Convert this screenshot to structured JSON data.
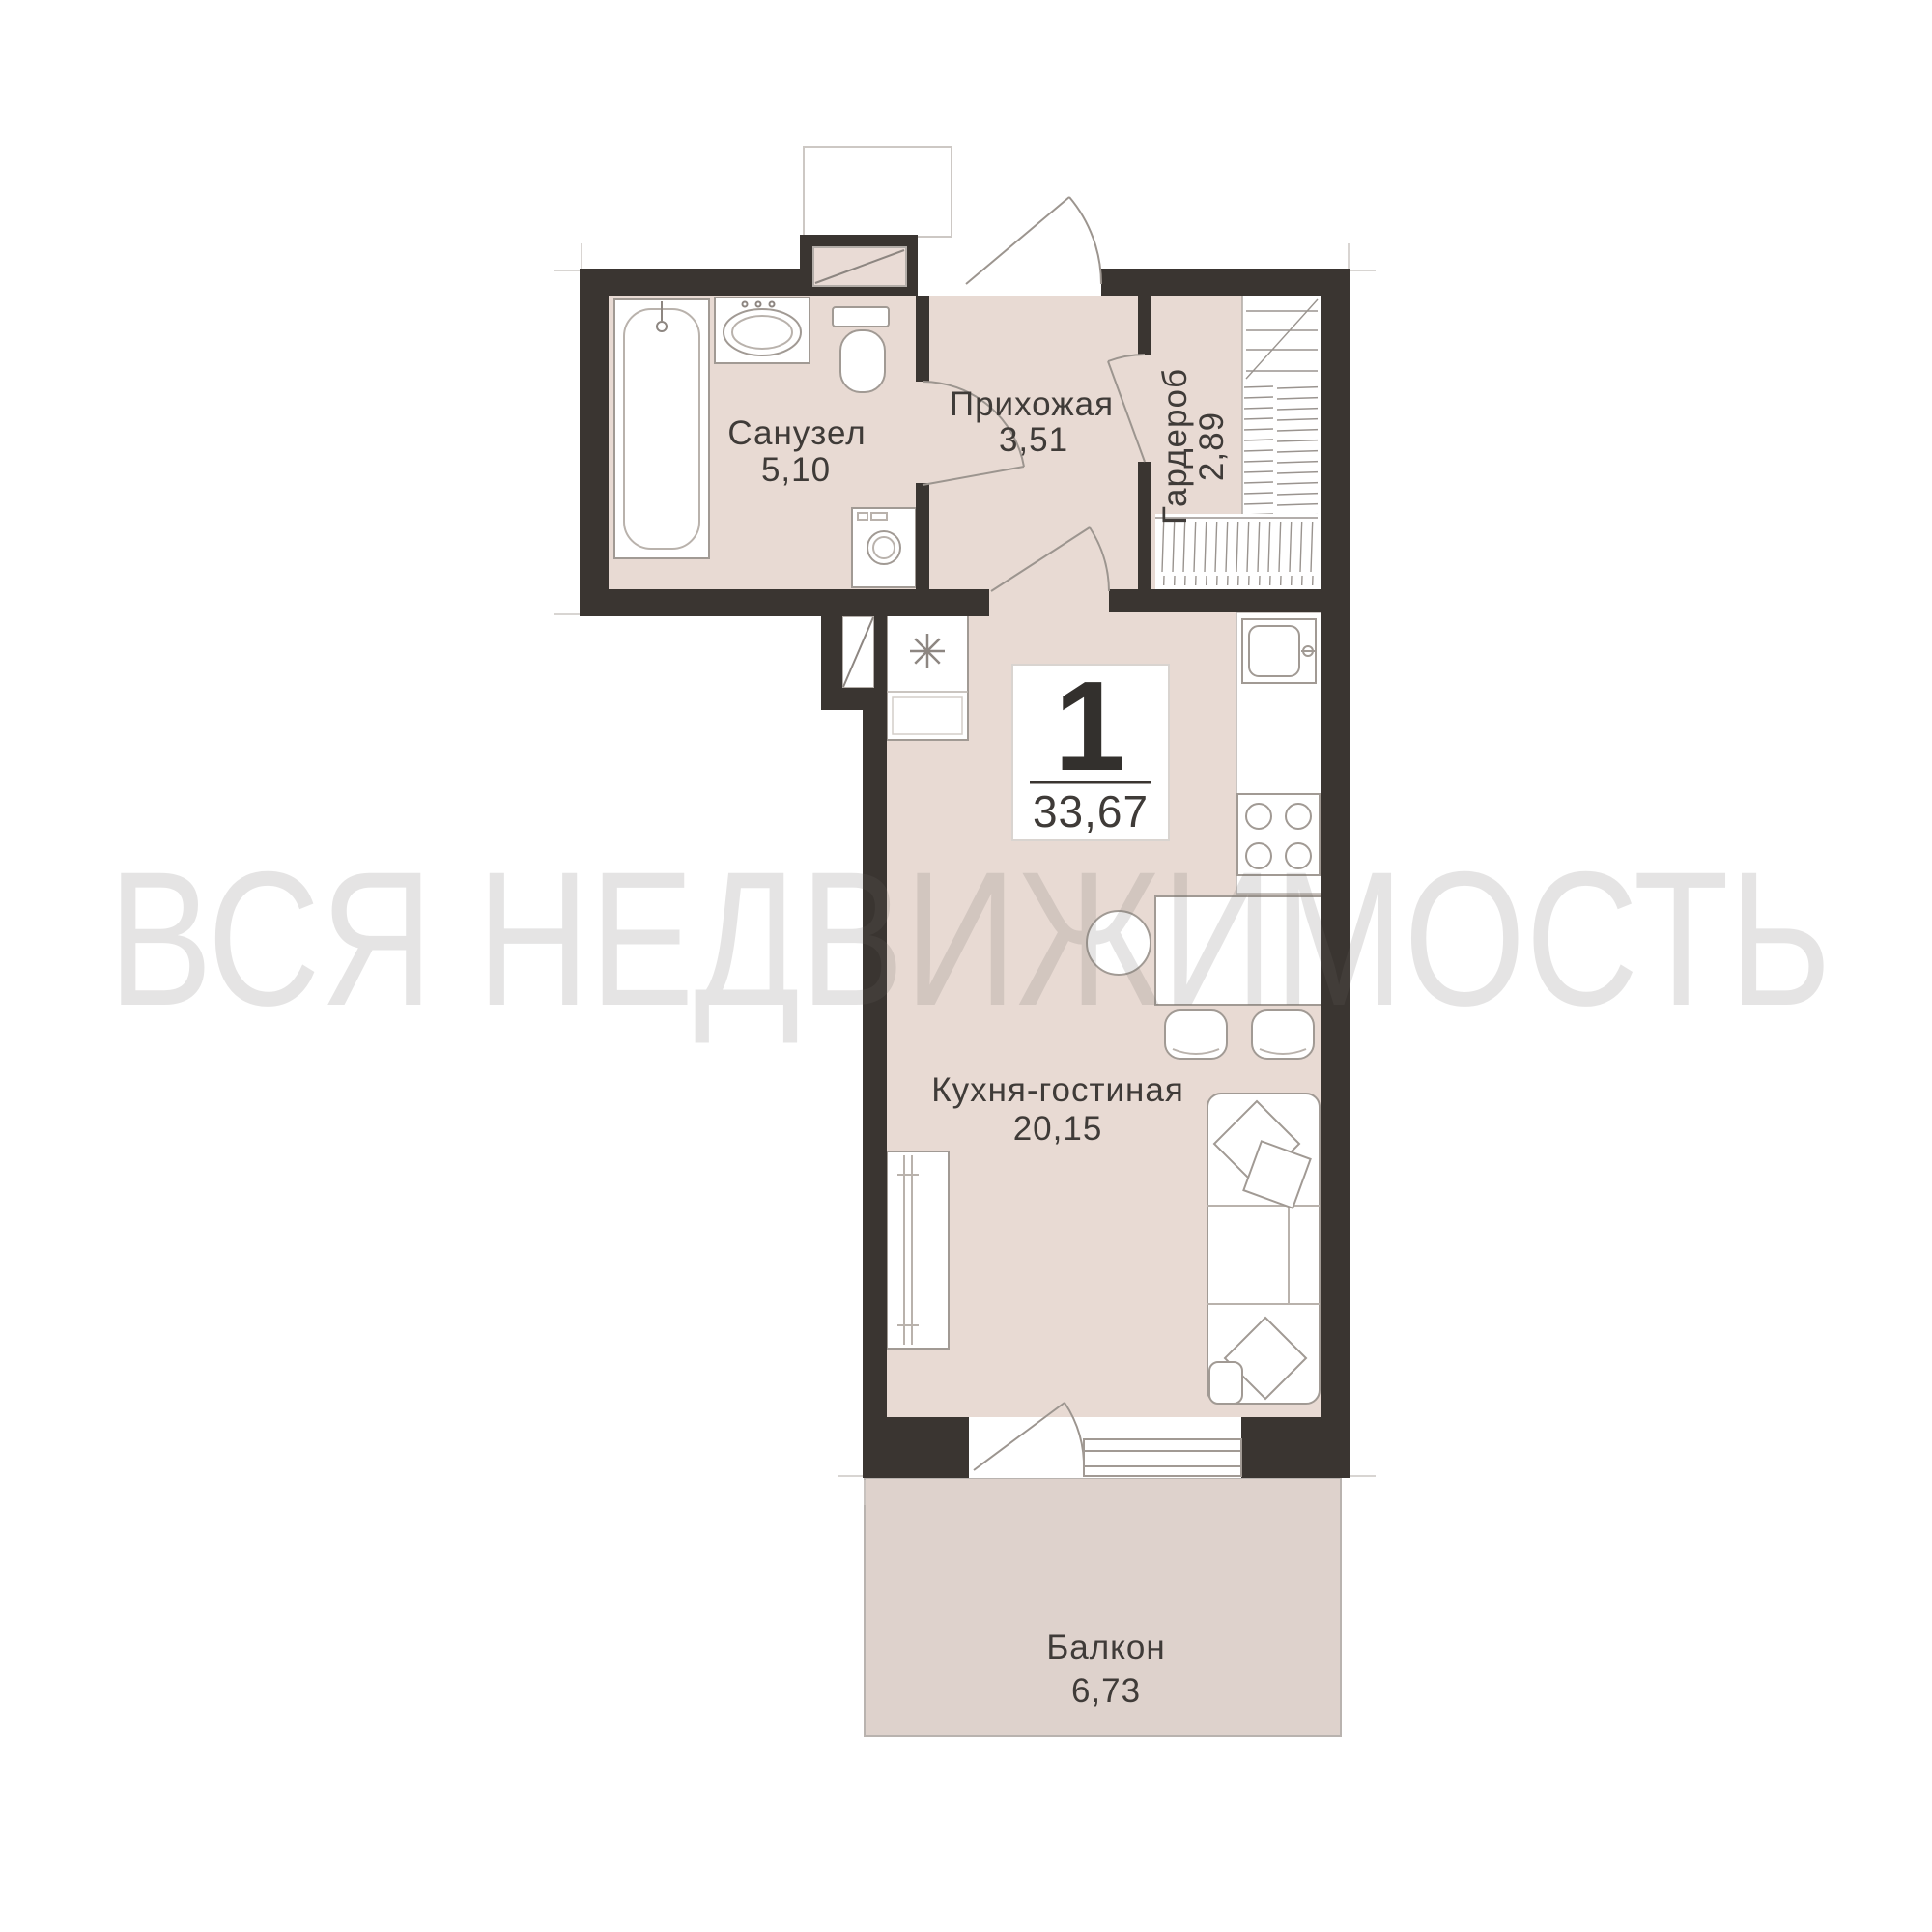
{
  "watermark": "ВСЯ НЕДВИЖИМОСТЬ",
  "unit_badge": {
    "rooms_count": "1",
    "total_area": "33,67"
  },
  "rooms": [
    {
      "name": "Санузел",
      "area": "5,10"
    },
    {
      "name": "Прихожая",
      "area": "3,51"
    },
    {
      "name": "Гардероб",
      "area": "2,89"
    },
    {
      "name": "Кухня-гостиная",
      "area": "20,15"
    },
    {
      "name": "Балкон",
      "area": "6,73"
    }
  ],
  "colors": {
    "wall": "#3a3531",
    "floor": "#e8dad3",
    "balcony_floor": "#ded2cc",
    "fixture_stroke": "#a19a94",
    "label_text": "#3f3b38",
    "watermark": "#6b6764"
  },
  "icons": {
    "bathtub": "bathtub-icon",
    "bath_sink": "sink-icon",
    "toilet": "toilet-icon",
    "washing_machine": "washing-machine-icon",
    "vent_shaft": "vent-shaft-icon",
    "fridge": "fridge-snowflake-icon",
    "kitchen_sink": "kitchen-sink-icon",
    "stove": "stove-burners-icon",
    "dining_table": "dining-table-icon",
    "chair": "chair-icon",
    "sofa": "sofa-icon",
    "pillow": "pillow-icon",
    "wardrobe_rail": "wardrobe-hangers-icon",
    "door": "door-swing-icon",
    "window": "window-icon"
  }
}
